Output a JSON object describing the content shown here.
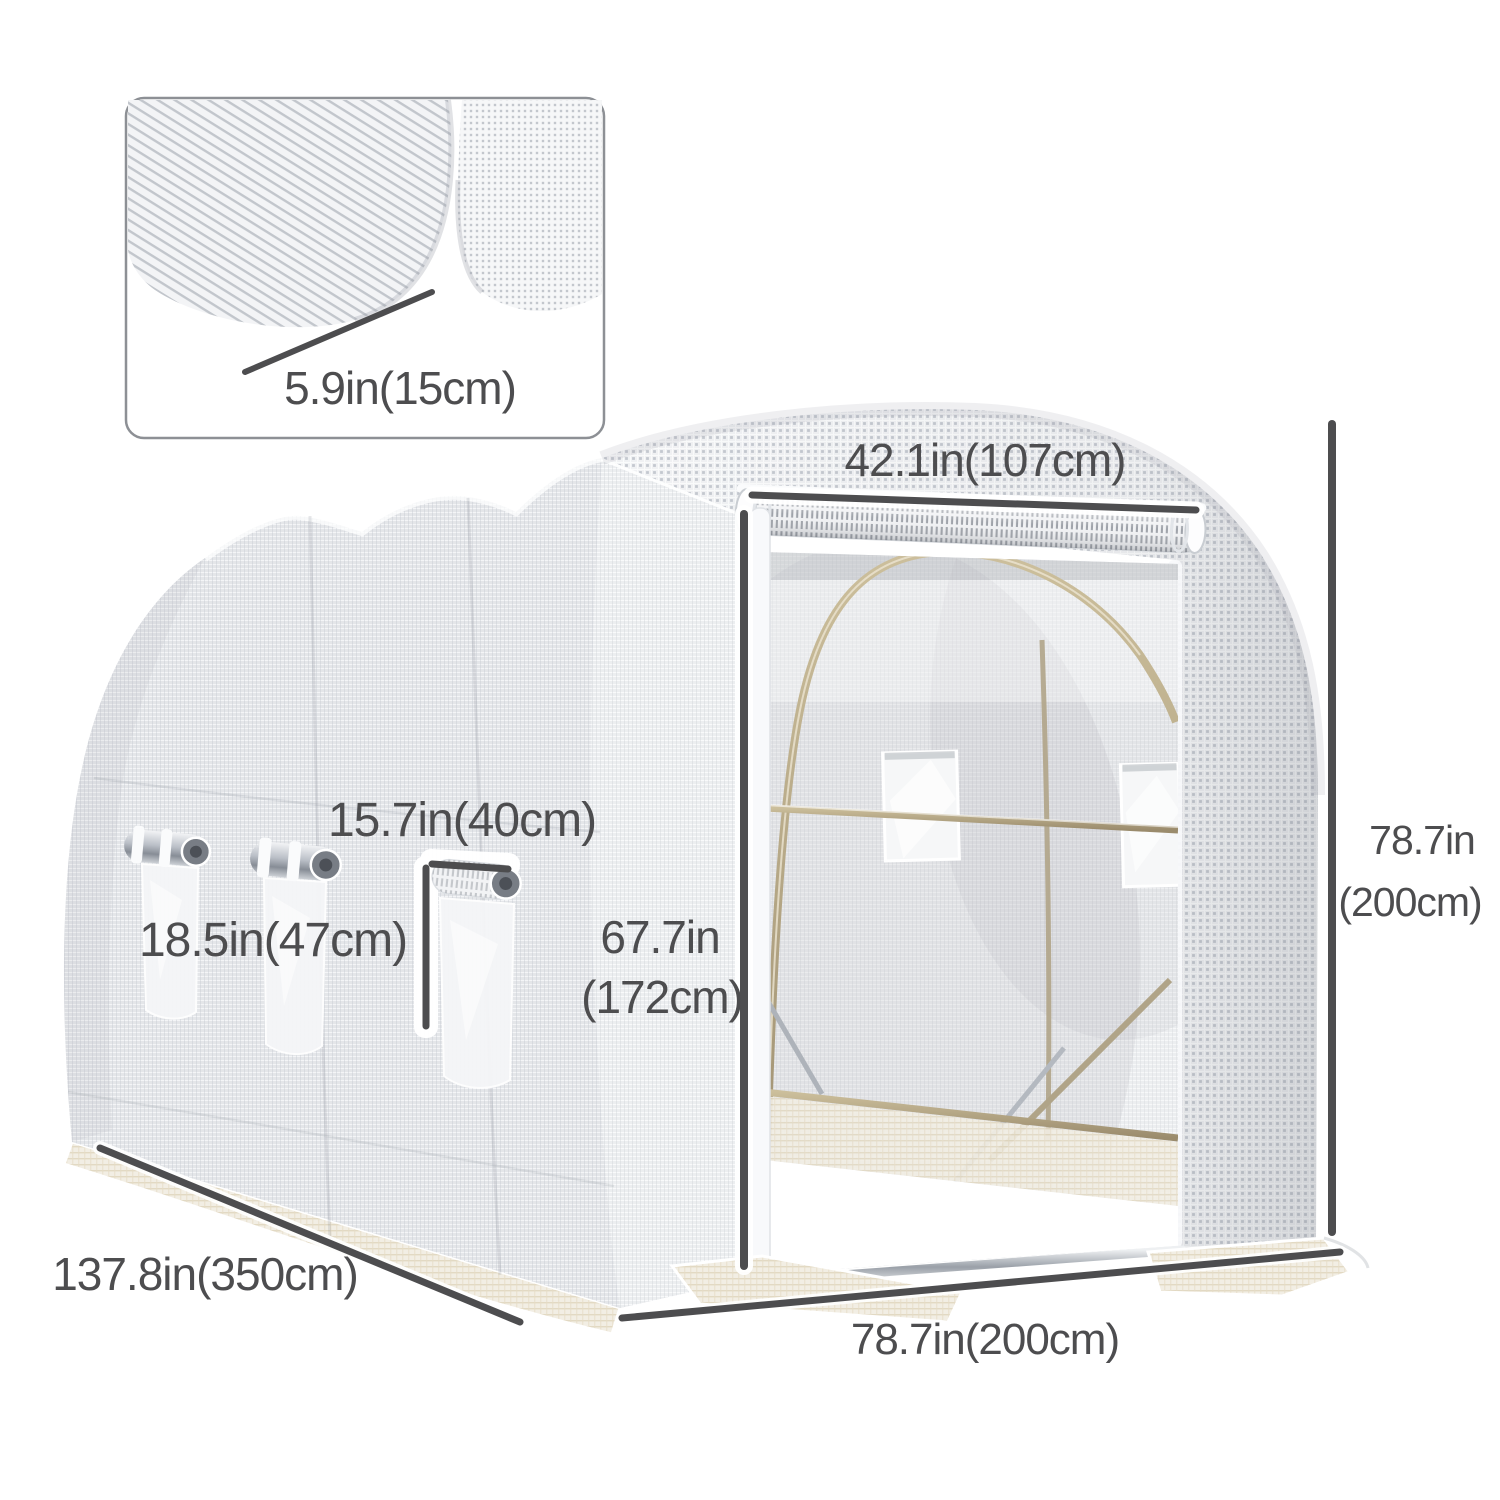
{
  "page": {
    "background": "#ffffff"
  },
  "colors": {
    "annotation": "#4d4d4f",
    "mesh_side": "#e4e6e9",
    "mesh_front": "#f1f2f4",
    "frame_tan": "#a89a7c",
    "metal_silver": "#9aa0a8"
  },
  "inset": {
    "detail_label": "5.9in(15cm)"
  },
  "greenhouse": {
    "door_width_label": "42.1in(107cm)",
    "total_height_label_in": "78.7in",
    "total_height_label_cm": "(200cm)",
    "window_width_label": "15.7in(40cm)",
    "window_height_label": "18.5in(47cm)",
    "door_height_label_in": "67.7in",
    "door_height_label_cm": "(172cm)",
    "length_label": "137.8in(350cm)",
    "front_width_label": "78.7in(200cm)"
  }
}
